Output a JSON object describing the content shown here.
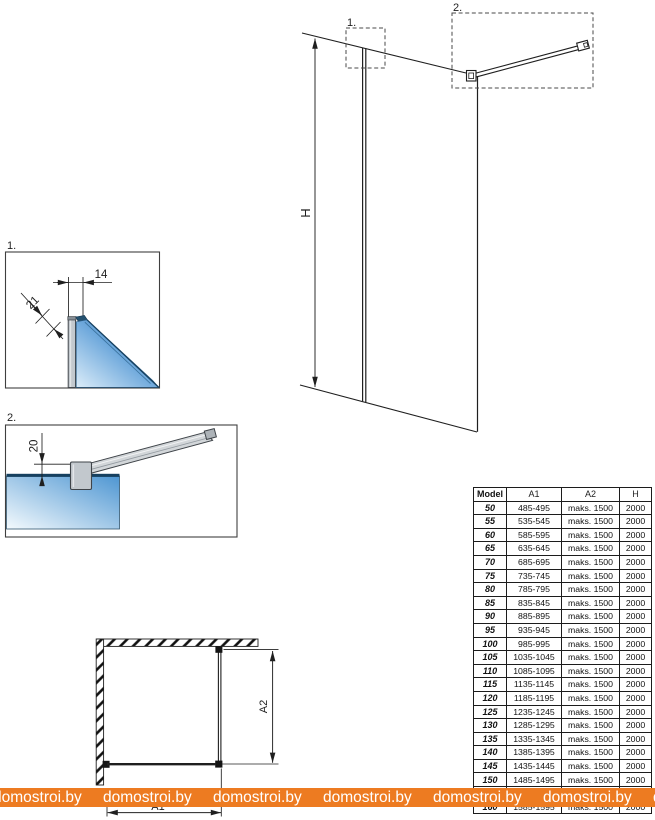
{
  "labels": {
    "callout1": "1.",
    "callout2": "2.",
    "height": "H",
    "dim14": "14",
    "dim21": "21",
    "dim20": "20",
    "a1": "A1",
    "a2": "A2"
  },
  "table": {
    "headers": [
      "Model",
      "A1",
      "A2",
      "H"
    ],
    "rows": [
      [
        "50",
        "485-495",
        "maks. 1500",
        "2000"
      ],
      [
        "55",
        "535-545",
        "maks. 1500",
        "2000"
      ],
      [
        "60",
        "585-595",
        "maks. 1500",
        "2000"
      ],
      [
        "65",
        "635-645",
        "maks. 1500",
        "2000"
      ],
      [
        "70",
        "685-695",
        "maks. 1500",
        "2000"
      ],
      [
        "75",
        "735-745",
        "maks. 1500",
        "2000"
      ],
      [
        "80",
        "785-795",
        "maks. 1500",
        "2000"
      ],
      [
        "85",
        "835-845",
        "maks. 1500",
        "2000"
      ],
      [
        "90",
        "885-895",
        "maks. 1500",
        "2000"
      ],
      [
        "95",
        "935-945",
        "maks. 1500",
        "2000"
      ],
      [
        "100",
        "985-995",
        "maks. 1500",
        "2000"
      ],
      [
        "105",
        "1035-1045",
        "maks. 1500",
        "2000"
      ],
      [
        "110",
        "1085-1095",
        "maks. 1500",
        "2000"
      ],
      [
        "115",
        "1135-1145",
        "maks. 1500",
        "2000"
      ],
      [
        "120",
        "1185-1195",
        "maks. 1500",
        "2000"
      ],
      [
        "125",
        "1235-1245",
        "maks. 1500",
        "2000"
      ],
      [
        "130",
        "1285-1295",
        "maks. 1500",
        "2000"
      ],
      [
        "135",
        "1335-1345",
        "maks. 1500",
        "2000"
      ],
      [
        "140",
        "1385-1395",
        "maks. 1500",
        "2000"
      ],
      [
        "145",
        "1435-1445",
        "maks. 1500",
        "2000"
      ],
      [
        "150",
        "1485-1495",
        "maks. 1500",
        "2000"
      ],
      [
        "155",
        "1535-1545",
        "maks. 1500",
        "2000"
      ],
      [
        "160",
        "1585-1595",
        "maks. 1500",
        "2000"
      ]
    ]
  },
  "watermark": {
    "text": "domostroi.by",
    "repeat": 7,
    "bar_color": "#ED7B21",
    "text_color": "#FFFFFF"
  },
  "colors": {
    "line": "#1f1f1f",
    "glass_deep": "#2368AE",
    "glass_light": "#E9F4FB",
    "glass_edge": "#16405F",
    "metal_gray": "#C3C9CE"
  }
}
